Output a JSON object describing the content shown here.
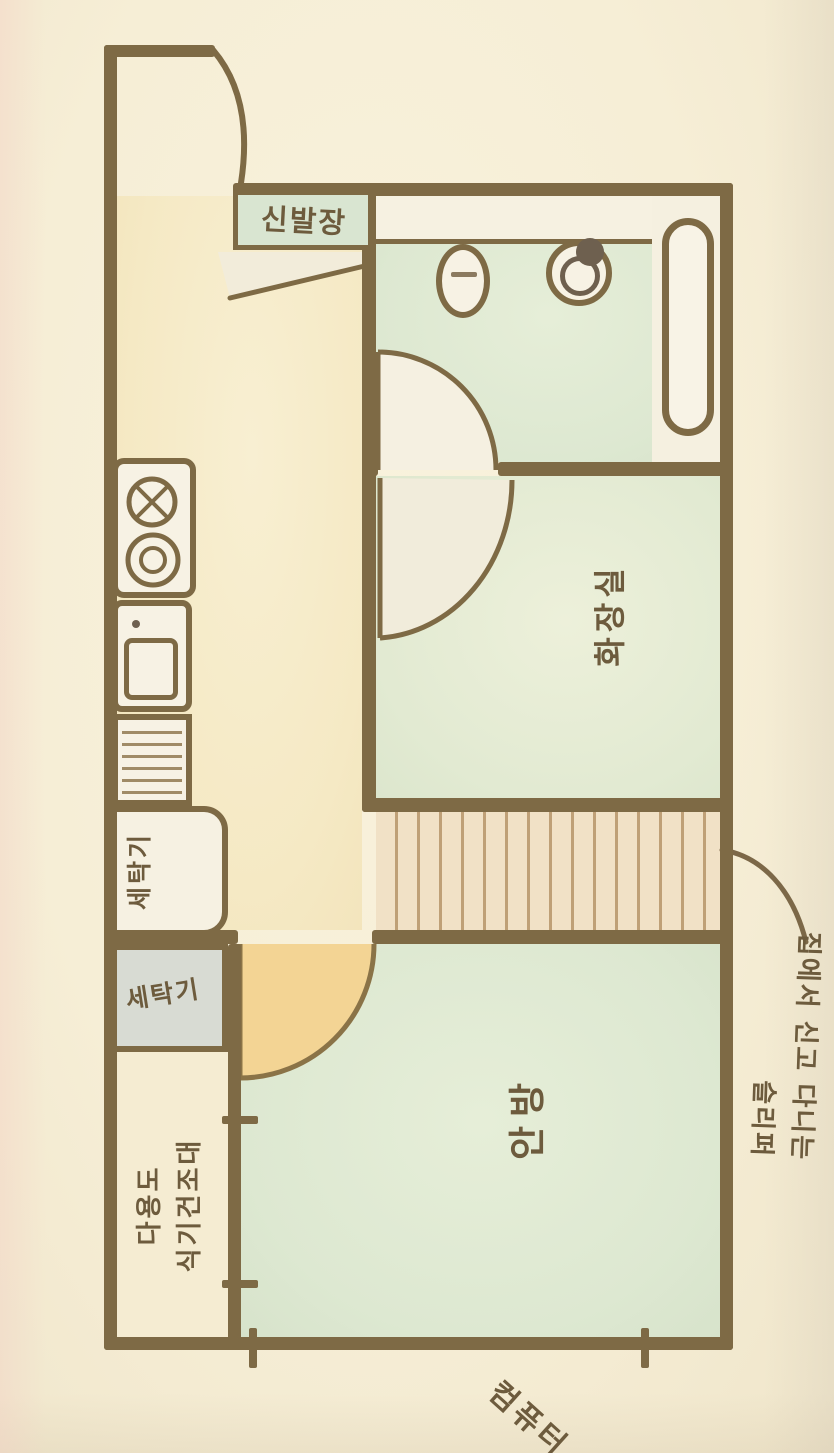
{
  "drawing": {
    "kind_note": "hand-drawn watercolor apartment floor plan",
    "labels": {
      "shoe_closet": "신발장",
      "bathroom_room": "화장실",
      "master_bedroom": "안방",
      "washing_machine_alcove": "세탁기",
      "washing_machine_box": "세탁기",
      "utility_area_line1": "다용도",
      "utility_area_line2": "식기건조대",
      "annotation_line1": "집에서 신고 다니는",
      "annotation_line2": "슬리퍼",
      "bottom_edge_label": "컴퓨터"
    },
    "fixtures": [
      "entry-door-swing-icon",
      "shoe-closet-box",
      "entry-step",
      "toilet-icon",
      "washbasin-icon",
      "bathtub-icon",
      "bathroom-door-swing-icon",
      "inner-room-door-swing-icon",
      "stove-burner-cross-icon",
      "stove-burner-rings-icon",
      "kitchen-sink-icon",
      "dish-rack-icon",
      "washing-machine-alcove",
      "washer-box",
      "bedroom-door-swing-icon",
      "corridor-floor-stripes",
      "dimension-tick-marks",
      "annotation-leader-line"
    ],
    "colors": {
      "paper": "#f6eed6",
      "wall_brown": "#7e6a45",
      "room_green": "#dde8d1",
      "kitchen_cream": "#f5e9c4",
      "corridor_floor": "#f1e1c6",
      "corridor_stripe": "#bfa077",
      "door_highlight": "#f3d494",
      "fixture_white": "#f6f1e2",
      "washer_box_gray": "#d8dbd3",
      "ink_brown": "#6d5b3d"
    }
  }
}
